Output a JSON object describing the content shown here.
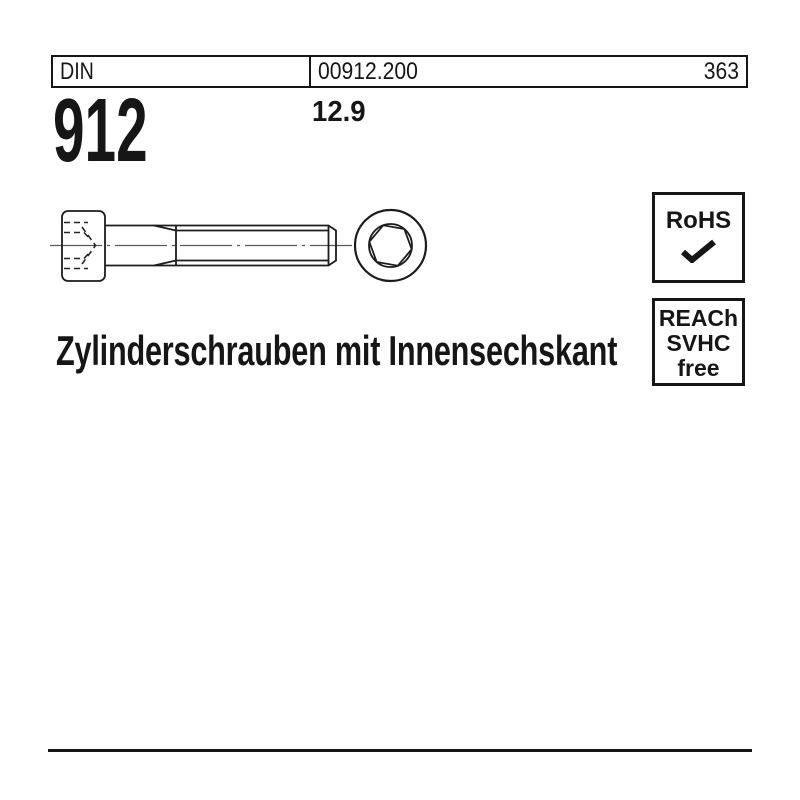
{
  "page": {
    "background": "#ffffff",
    "ink": "#161616",
    "centerline_color": "#5a5a5a"
  },
  "header": {
    "standard_label": "DIN",
    "catalog_number": "00912.200",
    "page_number": "363",
    "standard_number": "912",
    "strength_class": "12.9"
  },
  "title": "Zylinderschrauben mit Innensechskant",
  "badges": {
    "rohs": {
      "label": "RoHS",
      "check_icon": "checkmark"
    },
    "reach": {
      "lines": [
        "REACh",
        "SVHC",
        "free"
      ]
    }
  },
  "drawing": {
    "views": [
      "screw-side-view",
      "screw-end-view-hex-socket"
    ]
  }
}
